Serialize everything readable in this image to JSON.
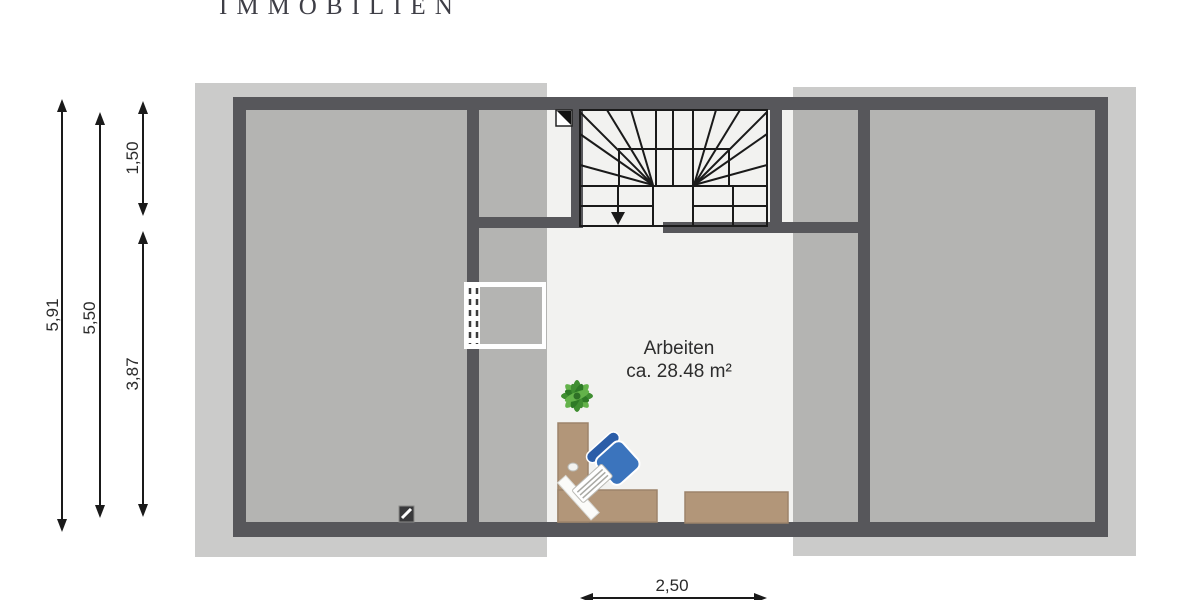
{
  "brand": {
    "logo_text": "IMMOBILIEN"
  },
  "plan": {
    "room": {
      "name": "Arbeiten",
      "area": "ca. 28.48 m²"
    },
    "dims": {
      "outer_height": "5,91",
      "inner_height": "5,50",
      "stair_depth": "1,50",
      "room_depth": "3,87",
      "stair_width": "2,50"
    }
  },
  "colors": {
    "roof_band": "#cbcbca",
    "wall": "#57575b",
    "shaded_room": "#b4b4b2",
    "open_room": "#f2f2f0",
    "line": "#1a1a1a",
    "wood": "#b29679",
    "wood_edge": "#9c836a",
    "chair_blue": "#3b74bd",
    "chair_back_blue": "#2b5da8",
    "plant_green": "#3f8e31"
  }
}
